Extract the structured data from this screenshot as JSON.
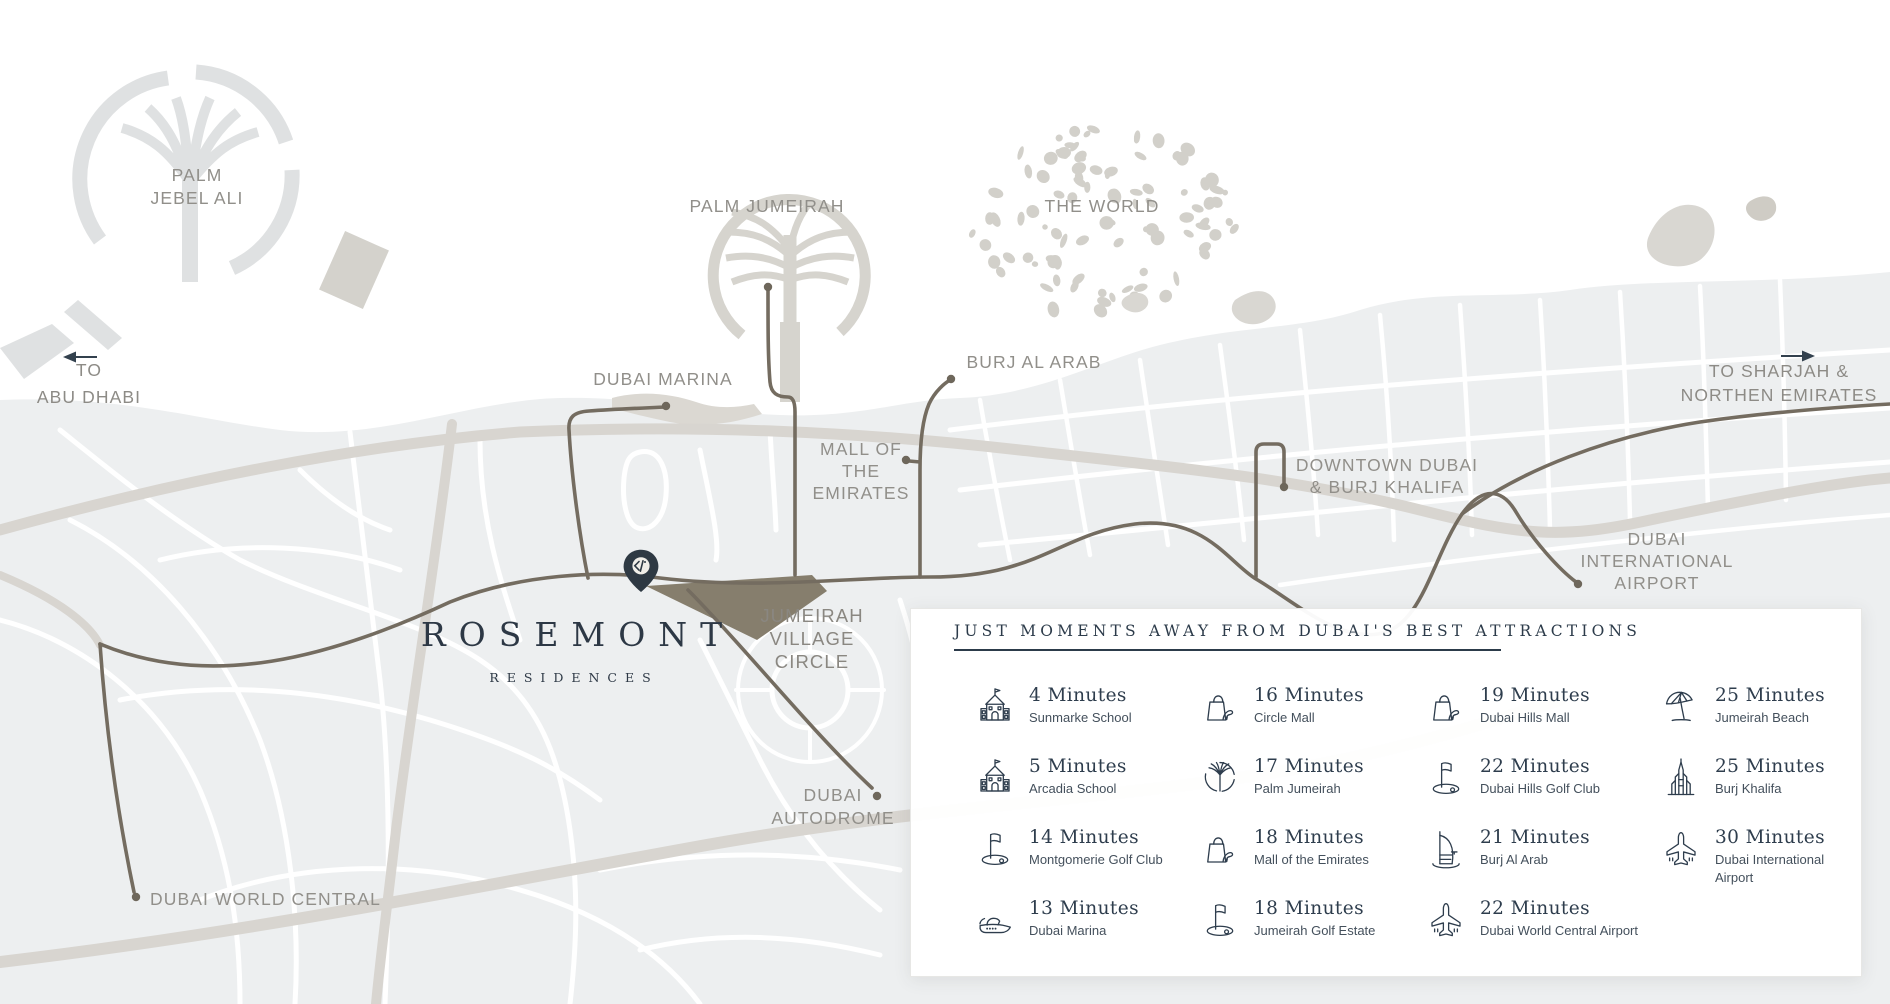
{
  "colors": {
    "accent": "#2e3d4d",
    "route": "#746c60",
    "land": "#edeff0",
    "highway": "#d8d5d0",
    "island": "#d6d4ce",
    "label": "#918f8a",
    "pin": "#2e3943",
    "plot": "#867e6d"
  },
  "map": {
    "logo": {
      "title": "ROSEMONT",
      "subtitle": "RESIDENCES"
    },
    "labels": {
      "palm_jebel_ali": [
        "PALM",
        "JEBEL ALI"
      ],
      "palm_jumeirah": [
        "PALM JUMEIRAH"
      ],
      "the_world": [
        "THE WORLD"
      ],
      "dubai_marina": [
        "DUBAI MARINA"
      ],
      "burj_al_arab": [
        "BURJ AL ARAB"
      ],
      "mall_of_emirates": [
        "MALL OF",
        "THE",
        "EMIRATES"
      ],
      "downtown": [
        "DOWNTOWN DUBAI",
        "& BURJ KHALIFA"
      ],
      "dxb_airport": [
        "DUBAI",
        "INTERNATIONAL",
        "AIRPORT"
      ],
      "jvc": [
        "JUMEIRAH",
        "VILLAGE",
        "CIRCLE"
      ],
      "autodrome": [
        "DUBAI",
        "AUTODROME"
      ],
      "dwc": [
        "DUBAI WORLD CENTRAL"
      ],
      "to_abu_dhabi": [
        "TO",
        "ABU DHABI"
      ],
      "to_sharjah": [
        "TO SHARJAH &",
        "NORTHEN EMIRATES"
      ]
    }
  },
  "panel": {
    "title": "JUST MOMENTS AWAY FROM DUBAI'S BEST ATTRACTIONS",
    "items": [
      {
        "icon": "school-icon",
        "time": "4 Minutes",
        "name": "Sunmarke School"
      },
      {
        "icon": "shopping-bag-icon",
        "time": "16 Minutes",
        "name": "Circle Mall"
      },
      {
        "icon": "shopping-bag-icon",
        "time": "19 Minutes",
        "name": "Dubai Hills Mall"
      },
      {
        "icon": "beach-umbrella-icon",
        "time": "25 Minutes",
        "name": "Jumeirah Beach"
      },
      {
        "icon": "school-icon",
        "time": "5 Minutes",
        "name": "Arcadia School"
      },
      {
        "icon": "palm-island-icon",
        "time": "17 Minutes",
        "name": "Palm Jumeirah"
      },
      {
        "icon": "golf-flag-icon",
        "time": "22 Minutes",
        "name": "Dubai Hills Golf Club"
      },
      {
        "icon": "burj-khalifa-icon",
        "time": "25 Minutes",
        "name": "Burj Khalifa"
      },
      {
        "icon": "golf-flag-icon",
        "time": "14 Minutes",
        "name": "Montgomerie Golf Club"
      },
      {
        "icon": "shopping-bag-icon",
        "time": "18 Minutes",
        "name": "Mall of the Emirates"
      },
      {
        "icon": "burj-al-arab-icon",
        "time": "21 Minutes",
        "name": "Burj Al Arab"
      },
      {
        "icon": "airplane-icon",
        "time": "30 Minutes",
        "name": "Dubai International Airport"
      },
      {
        "icon": "yacht-icon",
        "time": "13 Minutes",
        "name": "Dubai Marina"
      },
      {
        "icon": "golf-flag-icon",
        "time": "18 Minutes",
        "name": "Jumeirah Golf Estate"
      },
      {
        "icon": "airplane-icon",
        "time": "22 Minutes",
        "name": "Dubai World Central Airport"
      }
    ]
  }
}
